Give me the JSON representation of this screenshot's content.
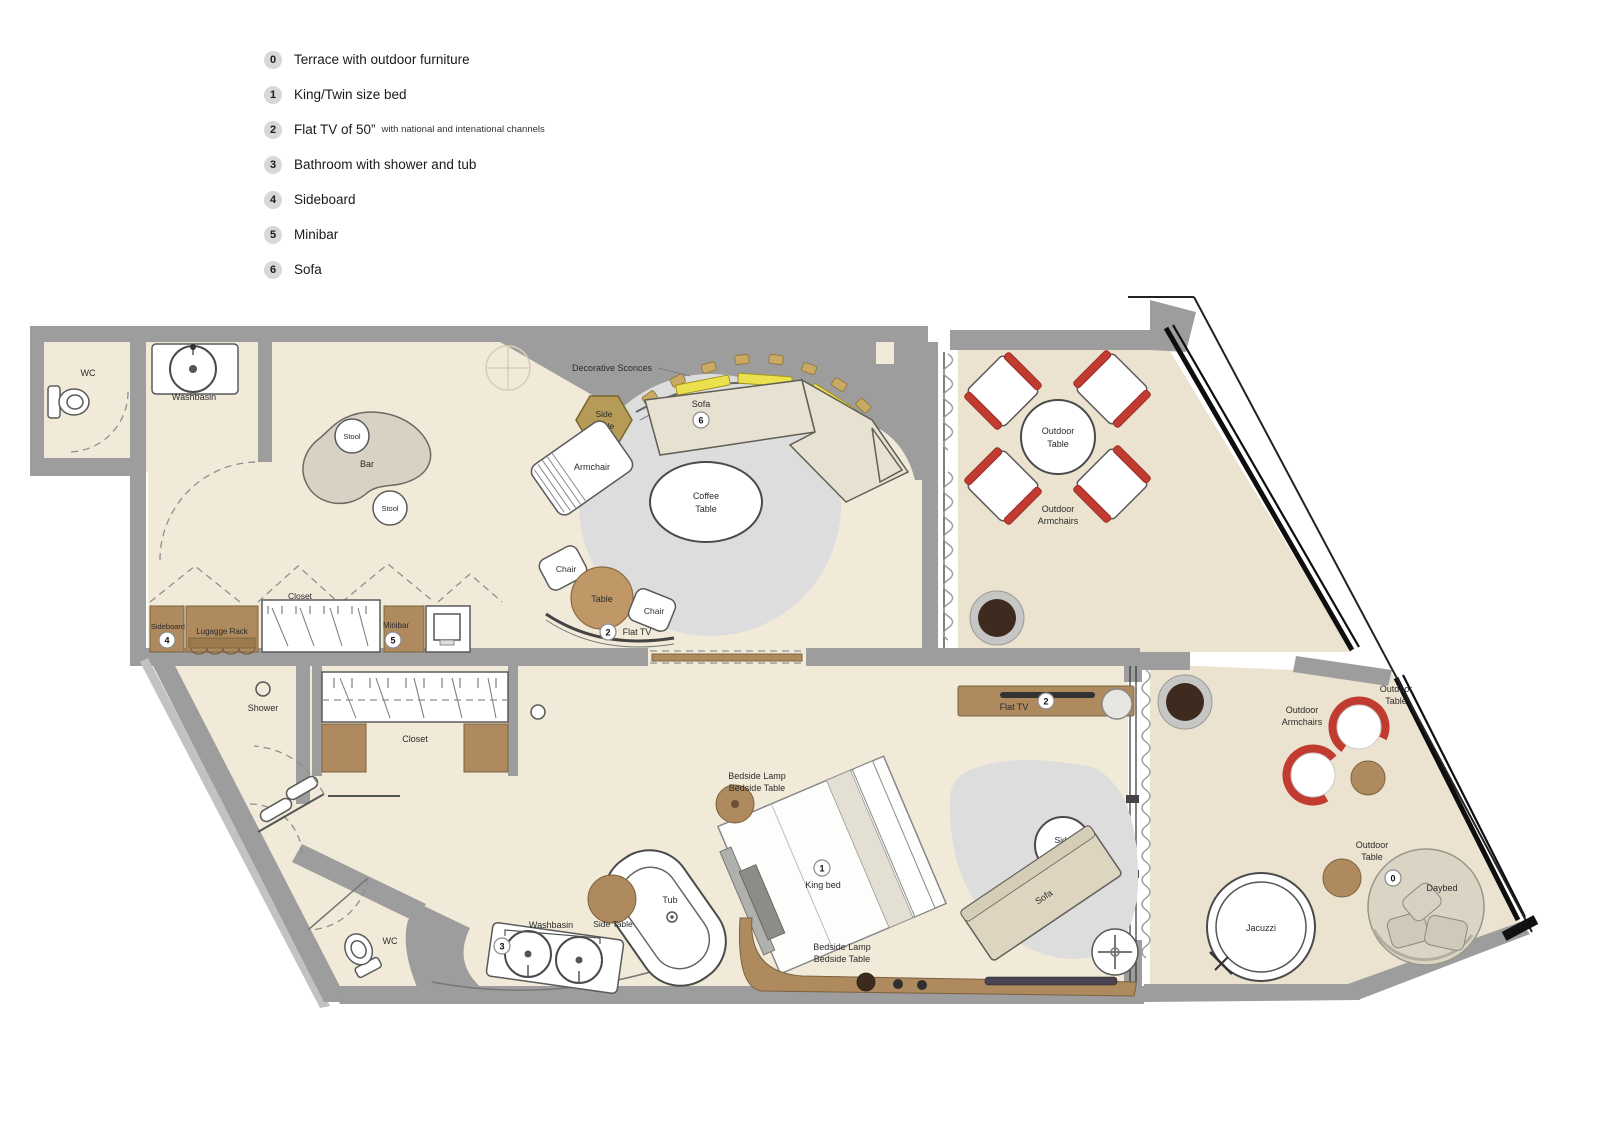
{
  "legend": {
    "items": [
      {
        "num": "0",
        "label": "Terrace with outdoor furniture",
        "suffix": ""
      },
      {
        "num": "1",
        "label": "King/Twin size bed",
        "suffix": ""
      },
      {
        "num": "2",
        "label": "Flat TV of 50”",
        "suffix": "with national and intenational channels"
      },
      {
        "num": "3",
        "label": "Bathroom with shower and tub",
        "suffix": ""
      },
      {
        "num": "4",
        "label": "Sideboard",
        "suffix": ""
      },
      {
        "num": "5",
        "label": "Minibar",
        "suffix": ""
      },
      {
        "num": "6",
        "label": "Sofa",
        "suffix": ""
      }
    ]
  },
  "plan": {
    "labels": {
      "wc_top": "WC",
      "washbasin_top": "Washbasin",
      "stool_top": "Stool",
      "bar": "Bar",
      "stool_bottom": "Stool",
      "decorative_sconces": "Decorative Sconces",
      "sofa_living": "Sofa",
      "side_table_living": [
        "Side",
        "Table"
      ],
      "armchair": "Armchair",
      "coffee_table": [
        "Coffee",
        "Table"
      ],
      "chair_left": "Chair",
      "table_round": "Table",
      "chair_right": "Chair",
      "flat_tv_living": "Flat TV",
      "outdoor_table_top": [
        "Outdoor",
        "Table"
      ],
      "outdoor_armchairs_top": [
        "Outdoor",
        "Armchairs"
      ],
      "sideboard": "Sideboard",
      "luggage_rack": "Lugagge Rack",
      "closet_top": "Closet",
      "minibar": "Minibar",
      "shower": "Shower",
      "closet_bottom": "Closet",
      "bedside_top": [
        "Bedside Lamp",
        "Bedside Table"
      ],
      "king_bed": "King bed",
      "bedside_bottom": [
        "Bedside Lamp",
        "Bedside Table"
      ],
      "flat_tv_bedroom": "Flat TV",
      "side_table_bedroom": [
        "Side",
        "Table"
      ],
      "sofa_bedroom": "Sofa",
      "washbasin_bottom": "Washbasin",
      "side_table_bath": "Side Table",
      "tub": "Tub",
      "wc_bottom": "WC",
      "outdoor_armchairs_right": [
        "Outdoor",
        "Armchairs"
      ],
      "outdoor_table_right": [
        "Outdoor",
        "Table"
      ],
      "outdoor_table_bottom": [
        "Outdoor",
        "Table"
      ],
      "jacuzzi": "Jacuzzi",
      "daybed": "Daybed"
    },
    "badges": {
      "terrace": "0",
      "bed": "1",
      "tv": "2",
      "bath": "3",
      "sideboard": "4",
      "minibar": "5",
      "sofa": "6"
    },
    "colors": {
      "floor": "#f1ead9",
      "terr": "#ebe3cf",
      "wall": "#9d9d9d",
      "wood": "#ae8a5e",
      "rug": "#dcdddc",
      "sofa": "#e7e1d1",
      "yellow": "#ebe04d",
      "red": "#c23b30"
    }
  }
}
